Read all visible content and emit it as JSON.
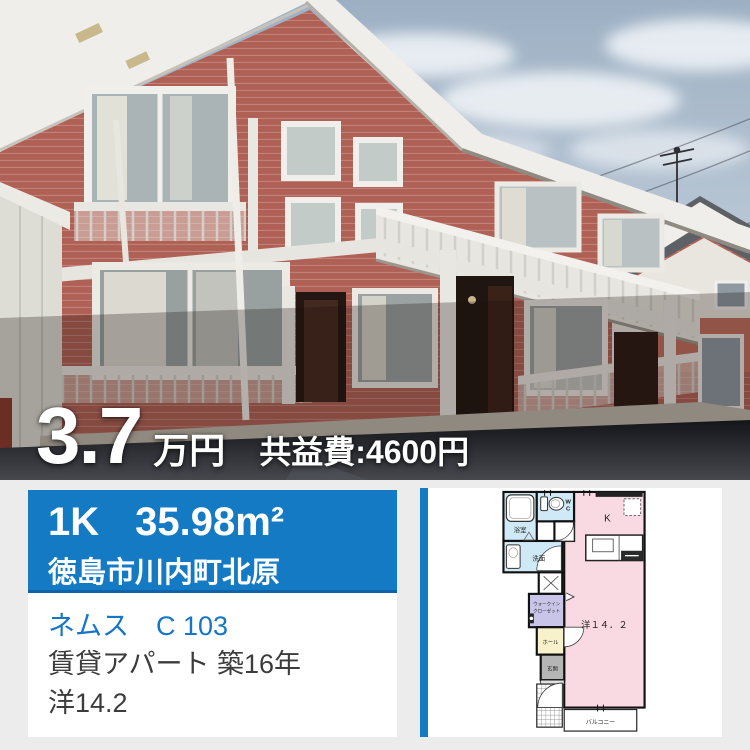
{
  "photo": {
    "price_amount": "3.7",
    "price_unit": "万円",
    "price_fee": "共益費:4600円"
  },
  "banner": {
    "layout": "1K",
    "area": "35.98m²",
    "address": "徳島市川内町北原"
  },
  "details": {
    "name": "ネムス　C 103",
    "building": "賃貸アパート 築16年",
    "room": "洋14.2"
  },
  "floorplan": {
    "bath": "浴室",
    "wc_line1": "W",
    "wc_line2": "C",
    "washroom": "洗面",
    "kitchen": "K",
    "closet_line1": "ウォークイン",
    "closet_line2": "クローゼット",
    "hall": "ホール",
    "entrance": "玄関",
    "main_room": "洋１４．２",
    "balcony": "バルコニー"
  },
  "colors": {
    "accent_blue": "#157ac4",
    "accent_blue_dark": "#0e63a8",
    "link_blue": "#1576c8",
    "background_gray": "#ececec",
    "plan_pink": "#f9d9e2",
    "plan_light_blue": "#cfeaf6",
    "plan_lavender": "#c9c5e8",
    "plan_yellow": "#f8f2cc",
    "plan_gray": "#b5b5b5",
    "price_text": "#ffffff"
  }
}
